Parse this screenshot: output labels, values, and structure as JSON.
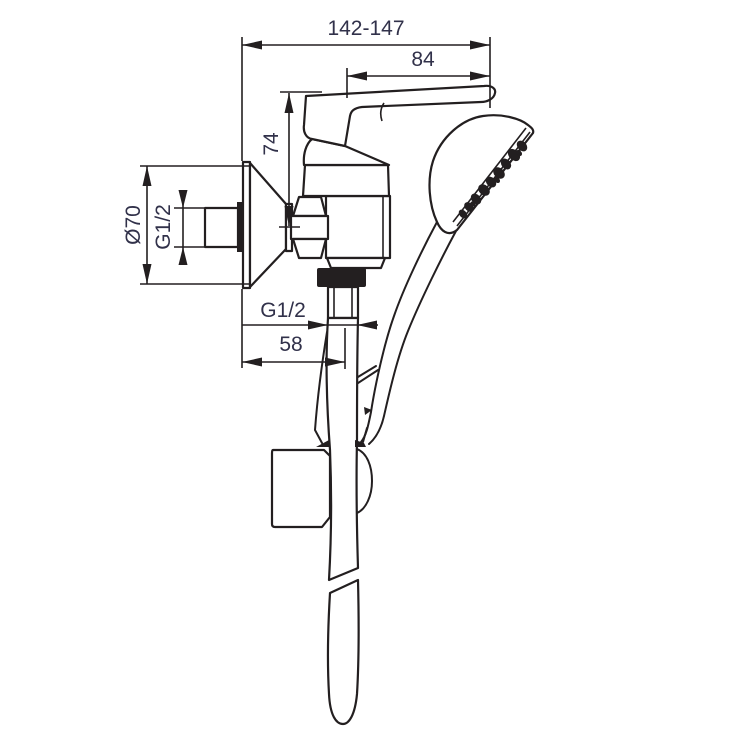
{
  "drawing": {
    "kind": "shower-mixer-installation-dimension-diagram",
    "colors": {
      "line": "#231f20",
      "text": "#31314a",
      "background": "#ffffff"
    },
    "labels": {
      "total_depth": "142-147",
      "lever_projection": "84",
      "lever_height": "74",
      "escutcheon_diameter": "Ø70",
      "inlet_thread": "G1/2",
      "outlet_thread": "G1/2",
      "outlet_offset": "58"
    }
  }
}
